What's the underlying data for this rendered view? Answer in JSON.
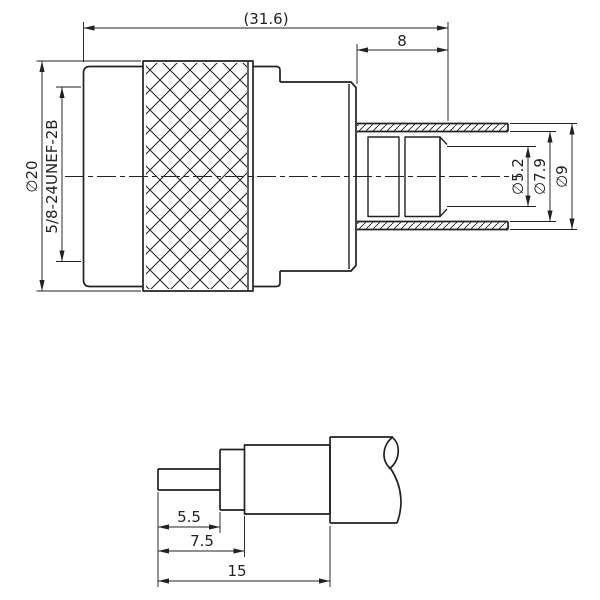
{
  "colors": {
    "line": "#222222",
    "background": "#ffffff"
  },
  "views": {
    "connector": {
      "dims": {
        "overall_length": "(31.6)",
        "sleeve_length": "8",
        "knurl_diameter": "∅20",
        "thread_spec": "5/8-24UNEF-2B",
        "bore_diameter": "∅5.2",
        "sleeve_inner_diameter": "∅7.9",
        "sleeve_outer_diameter": "∅9"
      }
    },
    "cable": {
      "dims": {
        "pin_length": "5.5",
        "dielectric_length": "7.5",
        "strip_length": "15"
      }
    }
  }
}
